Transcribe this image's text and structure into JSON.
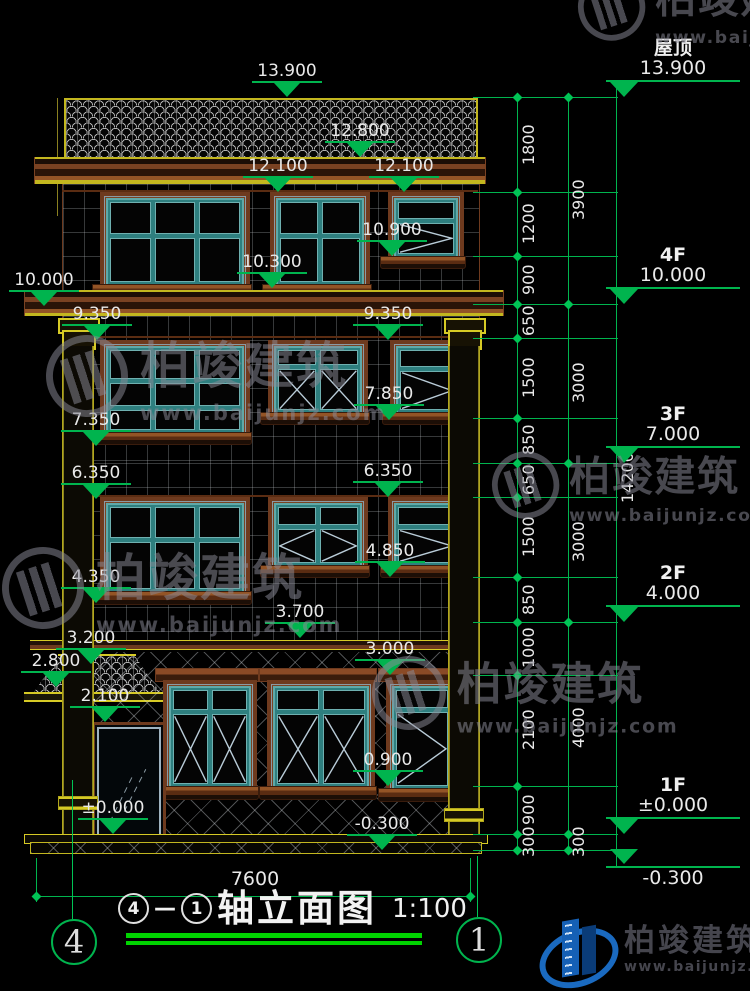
{
  "watermark": {
    "brand": "柏竣建筑",
    "url": "www.baijunjz.com"
  },
  "logo": {
    "brand": "柏竣建筑",
    "url": "www.baijunjz.com"
  },
  "title_block": {
    "axis_left": "4",
    "axis_right": "1",
    "name": "轴立面图",
    "scale": "1:100"
  },
  "bubbles": {
    "left": "4",
    "right": "1"
  },
  "dims": {
    "bottom_width": "7600",
    "total_height": "14200",
    "inner_chain": [
      "1800",
      "1200",
      "900",
      "650",
      "1500",
      "850",
      "650",
      "1500",
      "850",
      "1000",
      "2100",
      "900",
      "300"
    ],
    "outer_chain": [
      "3900",
      "3000",
      "3000",
      "4000",
      "300"
    ]
  },
  "floors": [
    {
      "label": "屋顶",
      "value": "13.900"
    },
    {
      "label": "4F",
      "value": "10.000"
    },
    {
      "label": "3F",
      "value": "7.000"
    },
    {
      "label": "2F",
      "value": "4.000"
    },
    {
      "label": "1F",
      "value": "±0.000"
    },
    {
      "label": "",
      "value": "-0.300"
    }
  ],
  "marks": [
    "13.900",
    "12.800",
    "12.100",
    "12.100",
    "10.900",
    "10.300",
    "10.000",
    "9.350",
    "9.350",
    "7.850",
    "7.350",
    "6.350",
    "6.350",
    "4.850",
    "4.350",
    "3.700",
    "3.200",
    "3.000",
    "2.800",
    "2.100",
    "0.900",
    "±0.000",
    "-0.300"
  ]
}
